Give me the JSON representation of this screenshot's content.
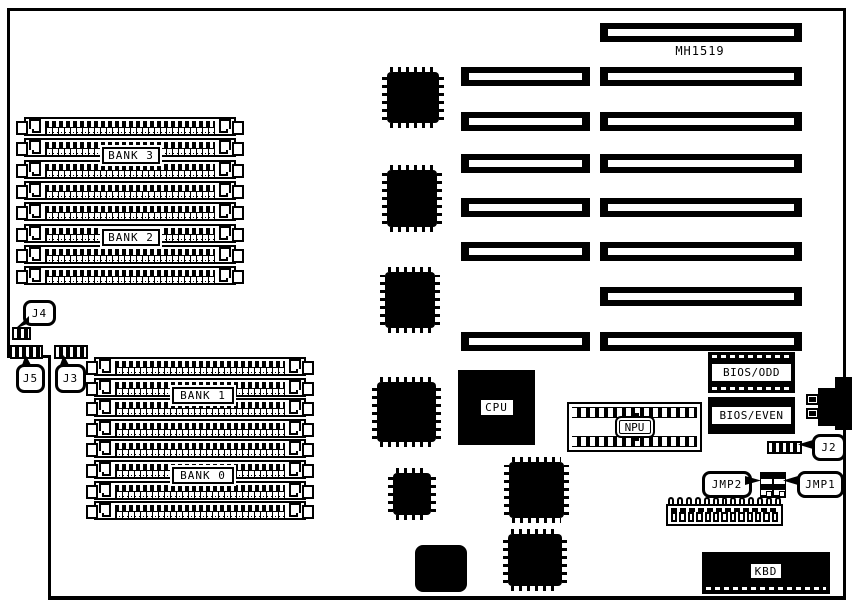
{
  "board": {
    "model_label": "MH1519",
    "memory": {
      "groups": [
        {
          "name": "upper-simm-group",
          "socket_count": 8,
          "bank_labels": [
            "BANK 3",
            "BANK 2"
          ]
        },
        {
          "name": "lower-simm-group",
          "socket_count": 8,
          "bank_labels": [
            "BANK 1",
            "BANK 0"
          ]
        }
      ]
    },
    "expansion_slots": {
      "count": 8,
      "rows": [
        {
          "left": false,
          "right": true
        },
        {
          "left": true,
          "right": true
        },
        {
          "left": true,
          "right": true
        },
        {
          "left": true,
          "right": true
        },
        {
          "left": true,
          "right": true
        },
        {
          "left": true,
          "right": true
        },
        {
          "left": false,
          "right": true
        },
        {
          "left": true,
          "right": true
        }
      ]
    },
    "chips": {
      "cpu": "CPU",
      "npu": "NPU",
      "bios_odd": "BIOS/ODD",
      "bios_even": "BIOS/EVEN",
      "keyboard": "KBD"
    },
    "jumpers": {
      "j4": "J4",
      "j5": "J5",
      "j3": "J3",
      "j2": "J2",
      "jmp2": "JMP2",
      "jmp1": "JMP1"
    },
    "power_connector": {
      "pin_count": 13
    },
    "colors": {
      "ink": "#000000",
      "paper": "#ffffff"
    }
  }
}
